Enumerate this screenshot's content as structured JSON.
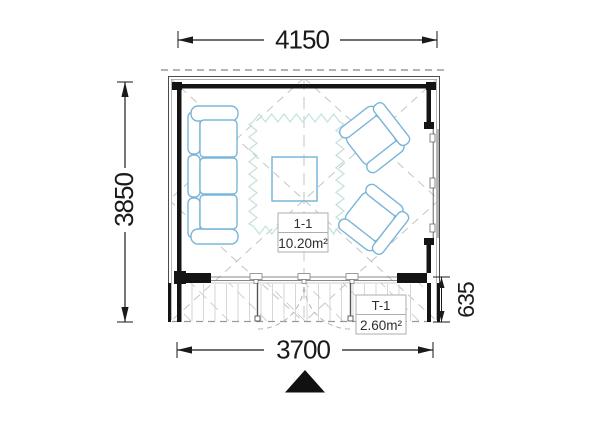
{
  "plan": {
    "type": "floor-plan",
    "dimensions": {
      "overall_width": "4150",
      "overall_depth": "3850",
      "terrace_width": "3700",
      "terrace_depth": "635"
    },
    "rooms": {
      "main": {
        "id": "1-1",
        "area": "10.20m²"
      },
      "terrace": {
        "id": "T-1",
        "area": "2.60m²"
      }
    },
    "colors": {
      "walls": "#141414",
      "wall_outline": "#4a4a4a",
      "furniture_outline": "#7ab5d9",
      "rug_outline": "#c6e2e1",
      "guides": "#c4c4c4",
      "dimension_text": "#1a1a1a",
      "label_border": "#aeaeae",
      "label_text": "#2e2e2e",
      "deck_lines": "#d6d6d6",
      "overhang_dash": "#9a9a9a"
    },
    "symbols": {
      "entrance_marker": "black-triangle-up"
    }
  }
}
